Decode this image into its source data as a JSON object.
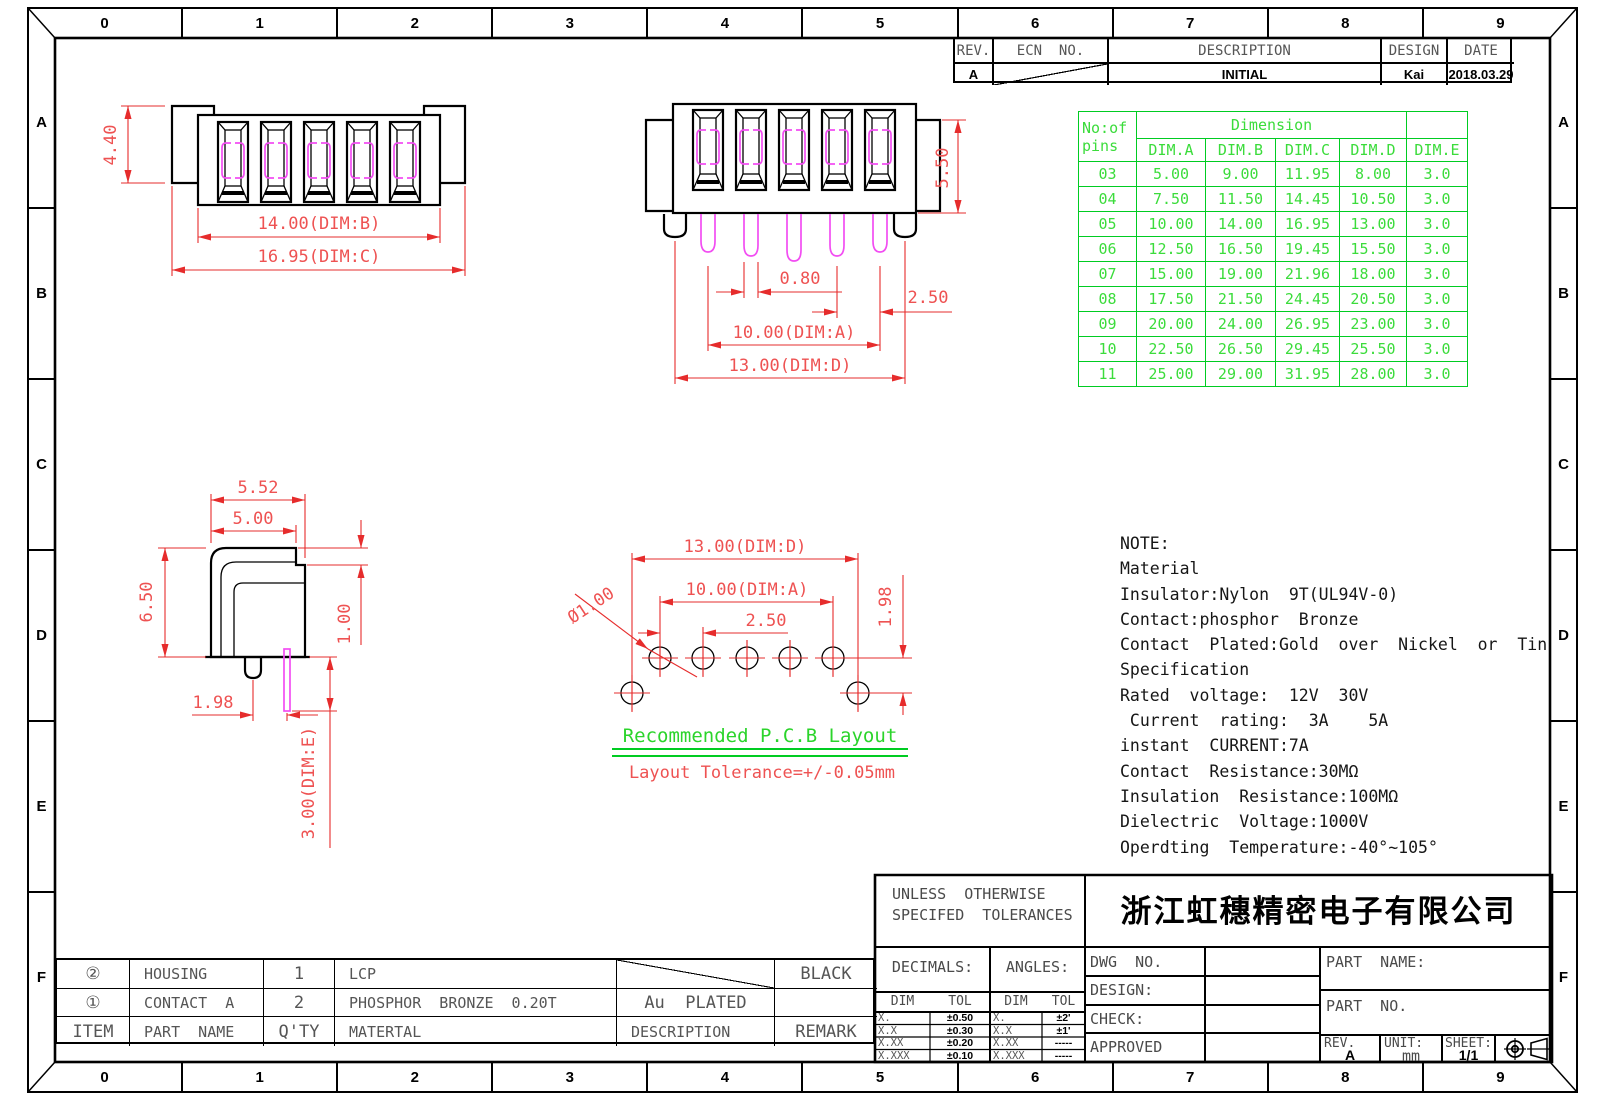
{
  "ruler": {
    "columns": [
      "0",
      "1",
      "2",
      "3",
      "4",
      "5",
      "6",
      "7",
      "8",
      "9"
    ],
    "rows": [
      "A",
      "B",
      "C",
      "D",
      "E",
      "F"
    ]
  },
  "revision_table": {
    "headers": [
      "REV.",
      "ECN  NO.",
      "DESCRIPTION",
      "DESIGN",
      "DATE"
    ],
    "row": {
      "rev": "A",
      "ecn": "",
      "description": "INITIAL",
      "design": "Kai",
      "date": "2018.03.29"
    }
  },
  "dimension_table": {
    "col_header_line1": "No:of",
    "col_header_line2": "pins",
    "group_header": "Dimension",
    "columns": [
      "DIM.A",
      "DIM.B",
      "DIM.C",
      "DIM.D",
      "DIM.E"
    ],
    "rows": [
      [
        "03",
        "5.00",
        "9.00",
        "11.95",
        "8.00",
        "3.0"
      ],
      [
        "04",
        "7.50",
        "11.50",
        "14.45",
        "10.50",
        "3.0"
      ],
      [
        "05",
        "10.00",
        "14.00",
        "16.95",
        "13.00",
        "3.0"
      ],
      [
        "06",
        "12.50",
        "16.50",
        "19.45",
        "15.50",
        "3.0"
      ],
      [
        "07",
        "15.00",
        "19.00",
        "21.96",
        "18.00",
        "3.0"
      ],
      [
        "08",
        "17.50",
        "21.50",
        "24.45",
        "20.50",
        "3.0"
      ],
      [
        "09",
        "20.00",
        "24.00",
        "26.95",
        "23.00",
        "3.0"
      ],
      [
        "10",
        "22.50",
        "26.50",
        "29.45",
        "25.50",
        "3.0"
      ],
      [
        "11",
        "25.00",
        "29.00",
        "31.95",
        "28.00",
        "3.0"
      ]
    ]
  },
  "notes": {
    "lines": [
      "NOTE:",
      "Material",
      "Insulator:Nylon  9T(UL94V-0)",
      "Contact:phosphor  Bronze",
      "Contact  Plated:Gold  over  Nickel  or  Tin",
      "Specification",
      "Rated  voltage:  12V  30V",
      " Current  rating:  3A    5A",
      "instant  CURRENT:7A",
      "Contact  Resistance:30MΩ",
      "Insulation  Resistance:100MΩ",
      "Dielectric  Voltage:1000V",
      "Operdting  Temperature:-40°~105°"
    ]
  },
  "dims": {
    "front": {
      "height": "4.40",
      "dim_b": "14.00(DIM:B)",
      "dim_c": "16.95(DIM:C)"
    },
    "top": {
      "height": "5.50",
      "pin_width": "0.80",
      "pitch": "2.50",
      "dim_a": "10.00(DIM:A)",
      "dim_d": "13.00(DIM:D)"
    },
    "side": {
      "w1": "5.52",
      "w2": "5.00",
      "h": "6.50",
      "step": "1.00",
      "offset": "1.98",
      "dim_e": "3.00(DIM:E)"
    },
    "pcb": {
      "dim_d": "13.00(DIM:D)",
      "dim_a": "10.00(DIM:A)",
      "pitch": "2.50",
      "hole": "Ø1.00",
      "offset": "1.98",
      "title": "Recommended  P.C.B  Layout",
      "tolerance": "Layout  Tolerance=+/-0.05mm"
    }
  },
  "title_block": {
    "tolerance_note_line1": "UNLESS  OTHERWISE",
    "tolerance_note_line2": "SPECIFED  TOLERANCES",
    "company": "浙江虹穗精密电子有限公司",
    "decimals_label": "DECIMALS:",
    "angles_label": "ANGLES:",
    "dim_col": "DIM",
    "tol_col": "TOL",
    "decimal_rows": [
      [
        "X.",
        "±0.50"
      ],
      [
        "X.X",
        "±0.30"
      ],
      [
        "X.XX",
        "±0.20"
      ],
      [
        "X.XXX",
        "±0.10"
      ]
    ],
    "angle_rows": [
      [
        "X.",
        "±2'"
      ],
      [
        "X.X",
        "±1'"
      ],
      [
        "X.XX",
        "-----"
      ],
      [
        "X.XXX",
        "-----"
      ]
    ],
    "dwg_no_label": "DWG  NO.",
    "design_label": "DESIGN:",
    "check_label": "CHECK:",
    "approved_label": "APPROVED",
    "part_name_label": "PART  NAME:",
    "part_no_label": "PART  NO.",
    "rev_label": "REV.",
    "rev_value": "A",
    "unit_label": "UNIT:",
    "unit_value": "mm",
    "sheet_label": "SHEET:",
    "sheet_value": "1/1"
  },
  "material_table": {
    "headers": [
      "ITEM",
      "PART  NAME",
      "Q'TY",
      "MATERTAL",
      "DESCRIPTION",
      "REMARK"
    ],
    "rows": [
      {
        "item": "②",
        "part_name": "HOUSING",
        "qty": "1",
        "material": "LCP",
        "description": "",
        "remark": "BLACK"
      },
      {
        "item": "①",
        "part_name": "CONTACT  A",
        "qty": "2",
        "material": "PHOSPHOR  BRONZE  0.20T",
        "description": "Au  PLATED",
        "remark": ""
      }
    ]
  },
  "colors": {
    "dimension": "#e62c2c",
    "table_green": "#00cc22",
    "magenta": "#f24df2",
    "line": "#000000"
  }
}
